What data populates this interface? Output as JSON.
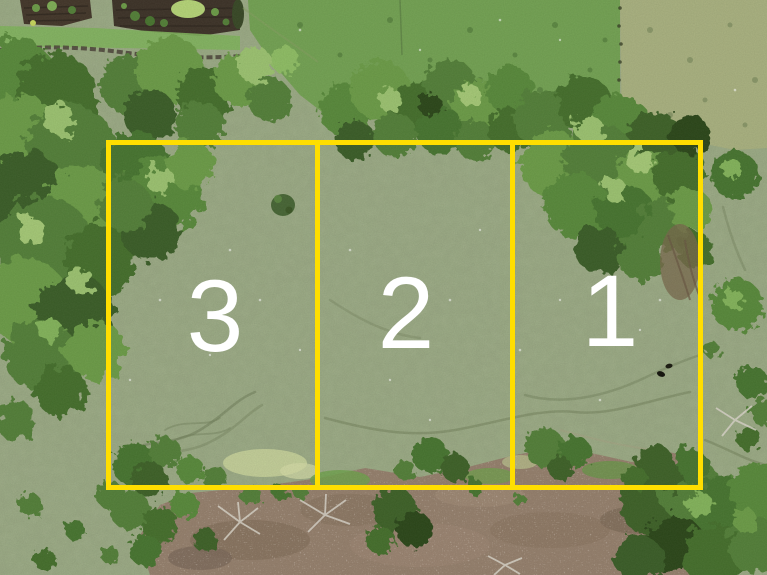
{
  "scene": {
    "description": "Aerial drone photo of grassland subdivided into three numbered lots outlined in yellow",
    "width_px": 767,
    "height_px": 575
  },
  "lots": [
    {
      "id": "lot-3",
      "label": "3",
      "position": "left"
    },
    {
      "id": "lot-2",
      "label": "2",
      "position": "middle"
    },
    {
      "id": "lot-1",
      "label": "1",
      "position": "right"
    }
  ],
  "colors": {
    "boundary": "#ffde00",
    "label": "#ffffff",
    "pasture": "#9aa884",
    "pasture-bright": "#74a254",
    "pasture-dry": "#a9b180",
    "tree-dark": "#3c5f29",
    "tree-mid": "#5a8a3c",
    "tree-light": "#84b35b",
    "dirt": "#95806d",
    "garden-soil": "#3f352a",
    "dead-branch": "#d8d3c8"
  }
}
